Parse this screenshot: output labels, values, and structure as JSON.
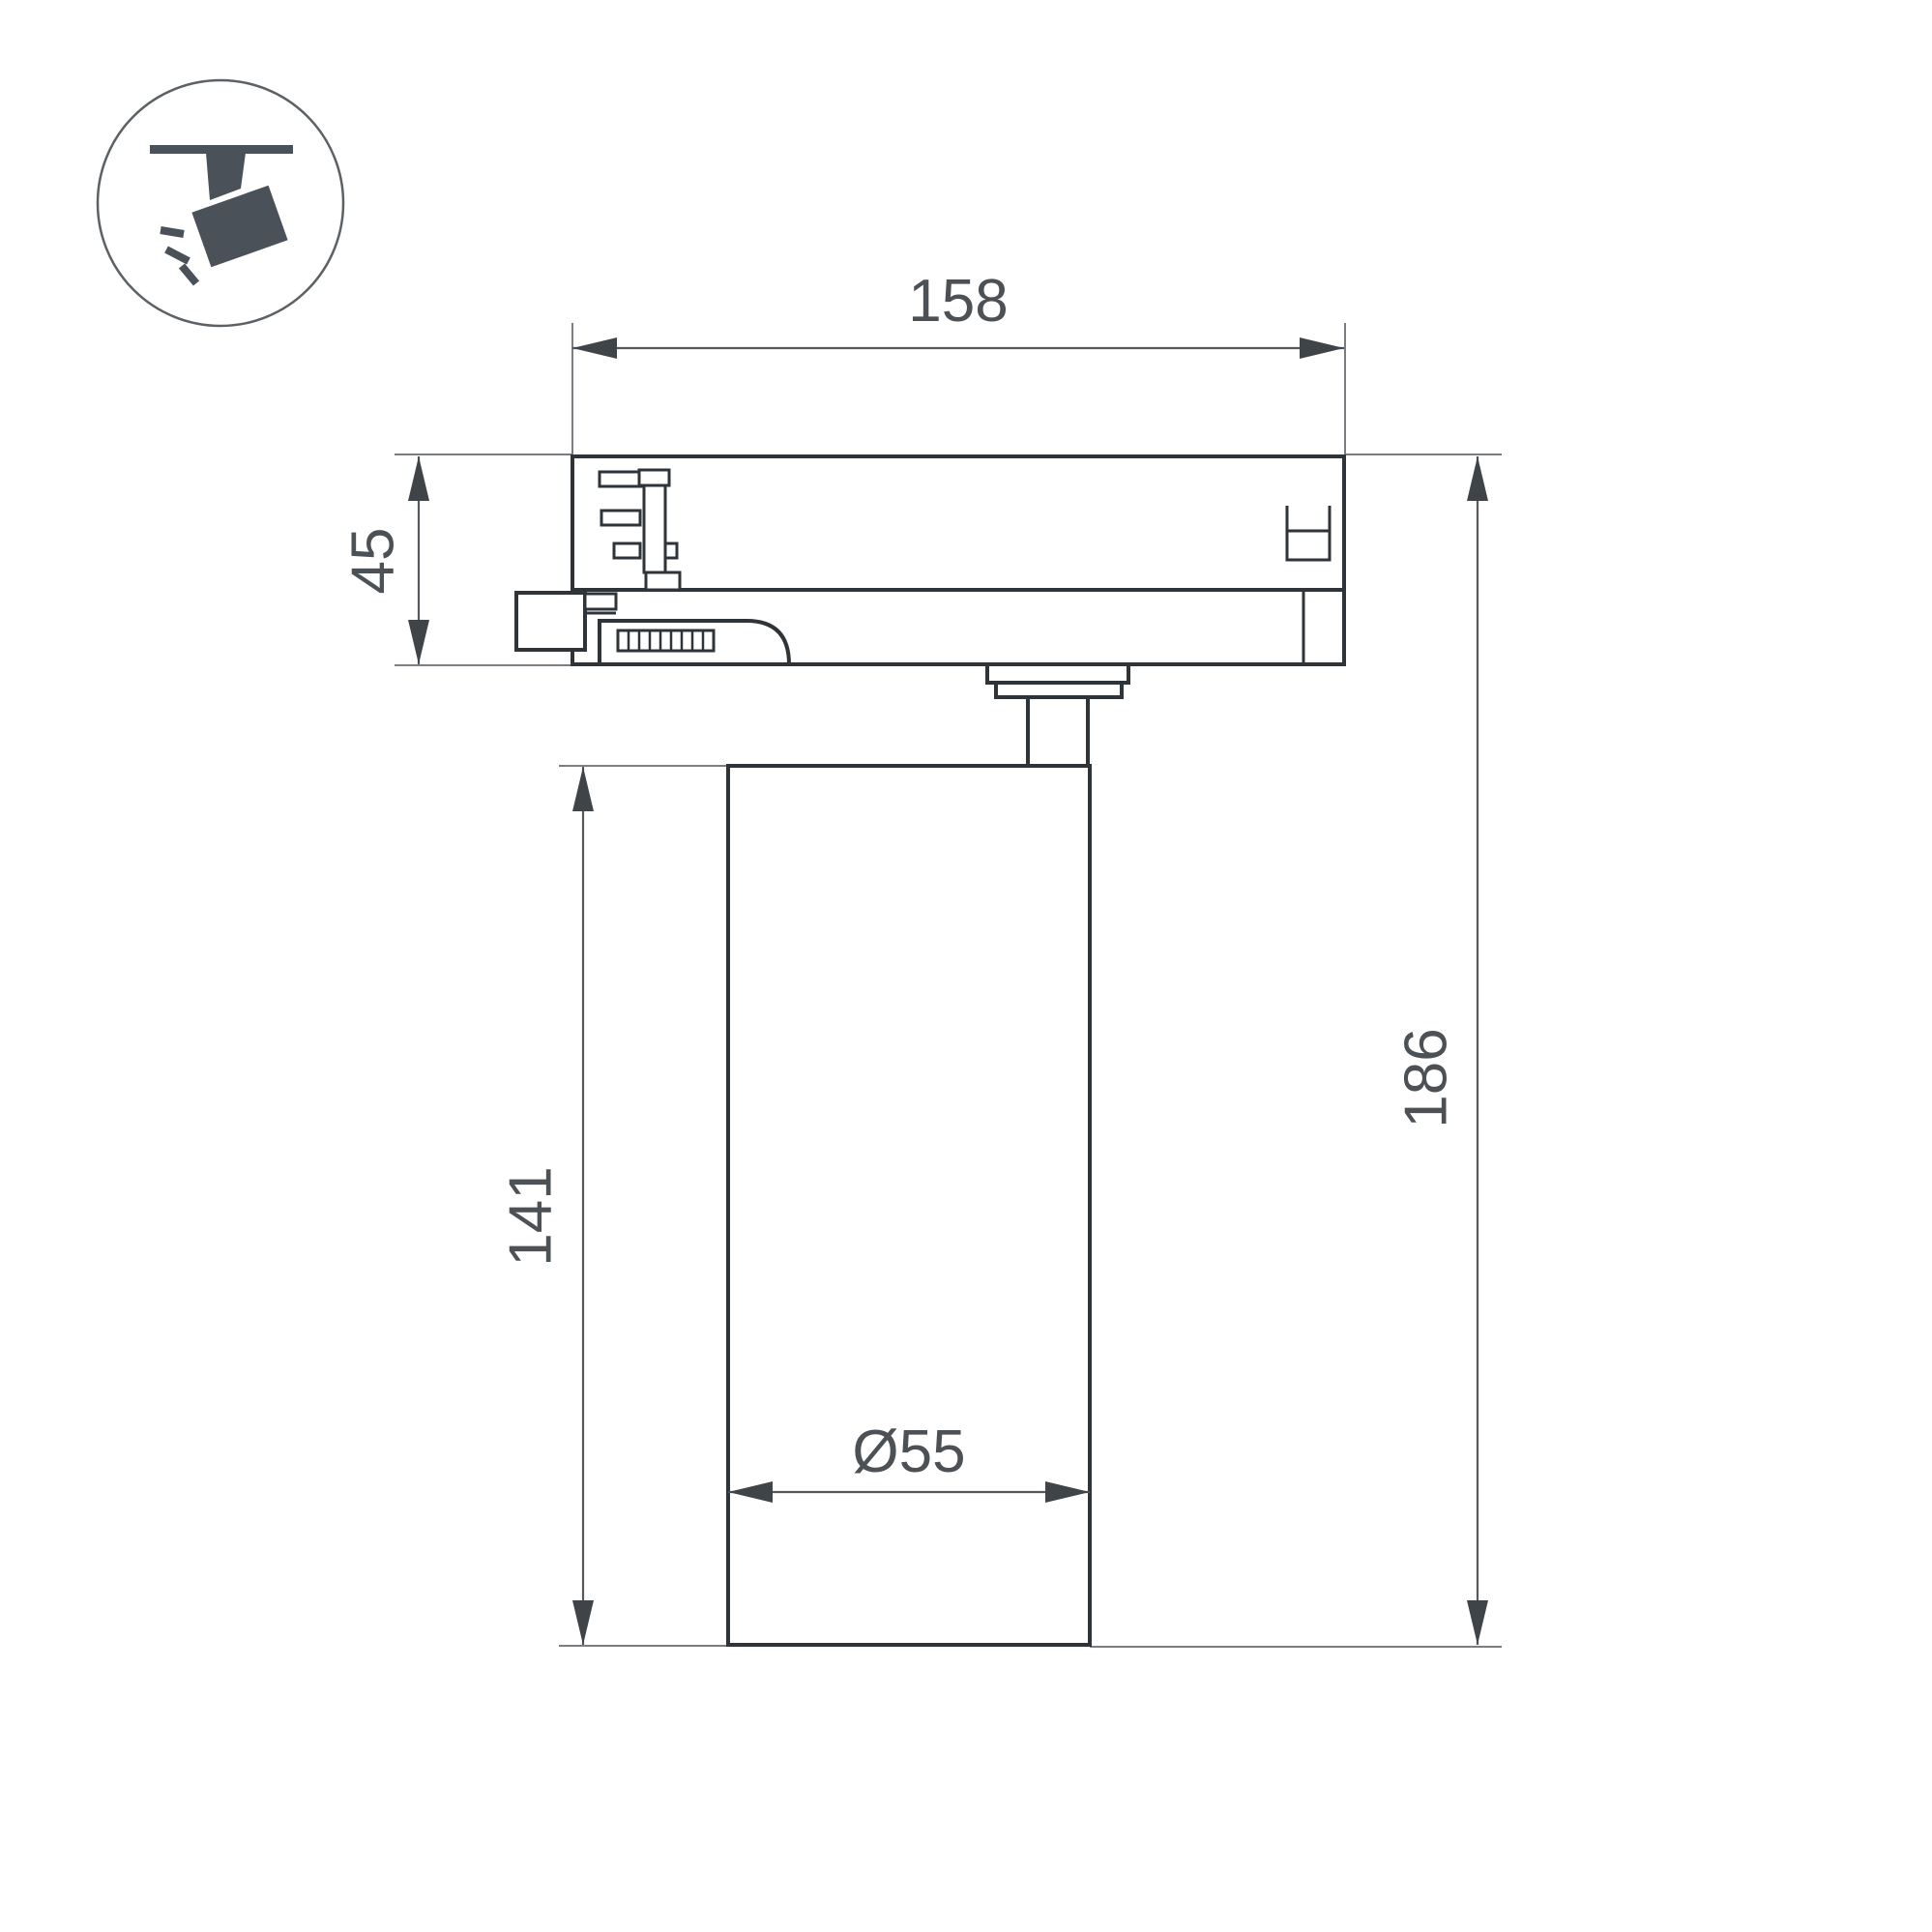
{
  "icon": {
    "name": "ceiling-track-spotlight"
  },
  "colors": {
    "outline": "#2f3438",
    "dimension_line": "#55595d",
    "extension_line": "#7a7e82",
    "arrow": "#3f4449",
    "label_text": "#4c5156",
    "icon": "#4a5158",
    "background": "#ffffff"
  },
  "dimensions": {
    "track_length": "158",
    "adapter_height": "45",
    "body_height": "141",
    "total_height": "186",
    "body_diameter": "Ø55"
  }
}
